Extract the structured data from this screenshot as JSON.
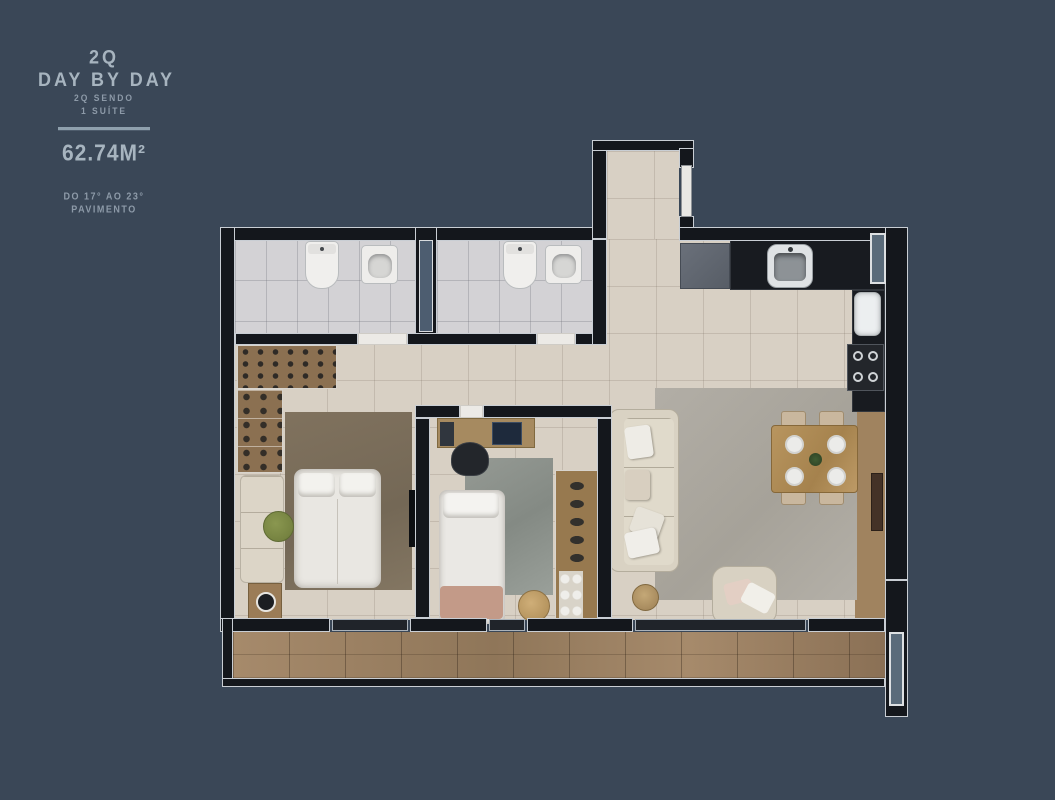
{
  "brand_panel": {
    "unit_type": "2Q",
    "unit_name": "DAY BY DAY",
    "subtitle_line1": "2Q SENDO",
    "subtitle_line2": "1 SUÍTE",
    "area": "62.74M²",
    "floor_range_line1": "DO 17° AO 23°",
    "floor_range_line2": "PAVIMENTO"
  },
  "colors": {
    "background": "#3a4757",
    "text": "#a7b4bf",
    "divider": "#8fa0ad",
    "wall": "#14171c",
    "wall_outline": "#c9ced4",
    "floor_tile": "#d8d0c4",
    "bath_tile": "#d3d2d5",
    "wood_deck": "#9a7f63",
    "counter": "#181b20"
  }
}
